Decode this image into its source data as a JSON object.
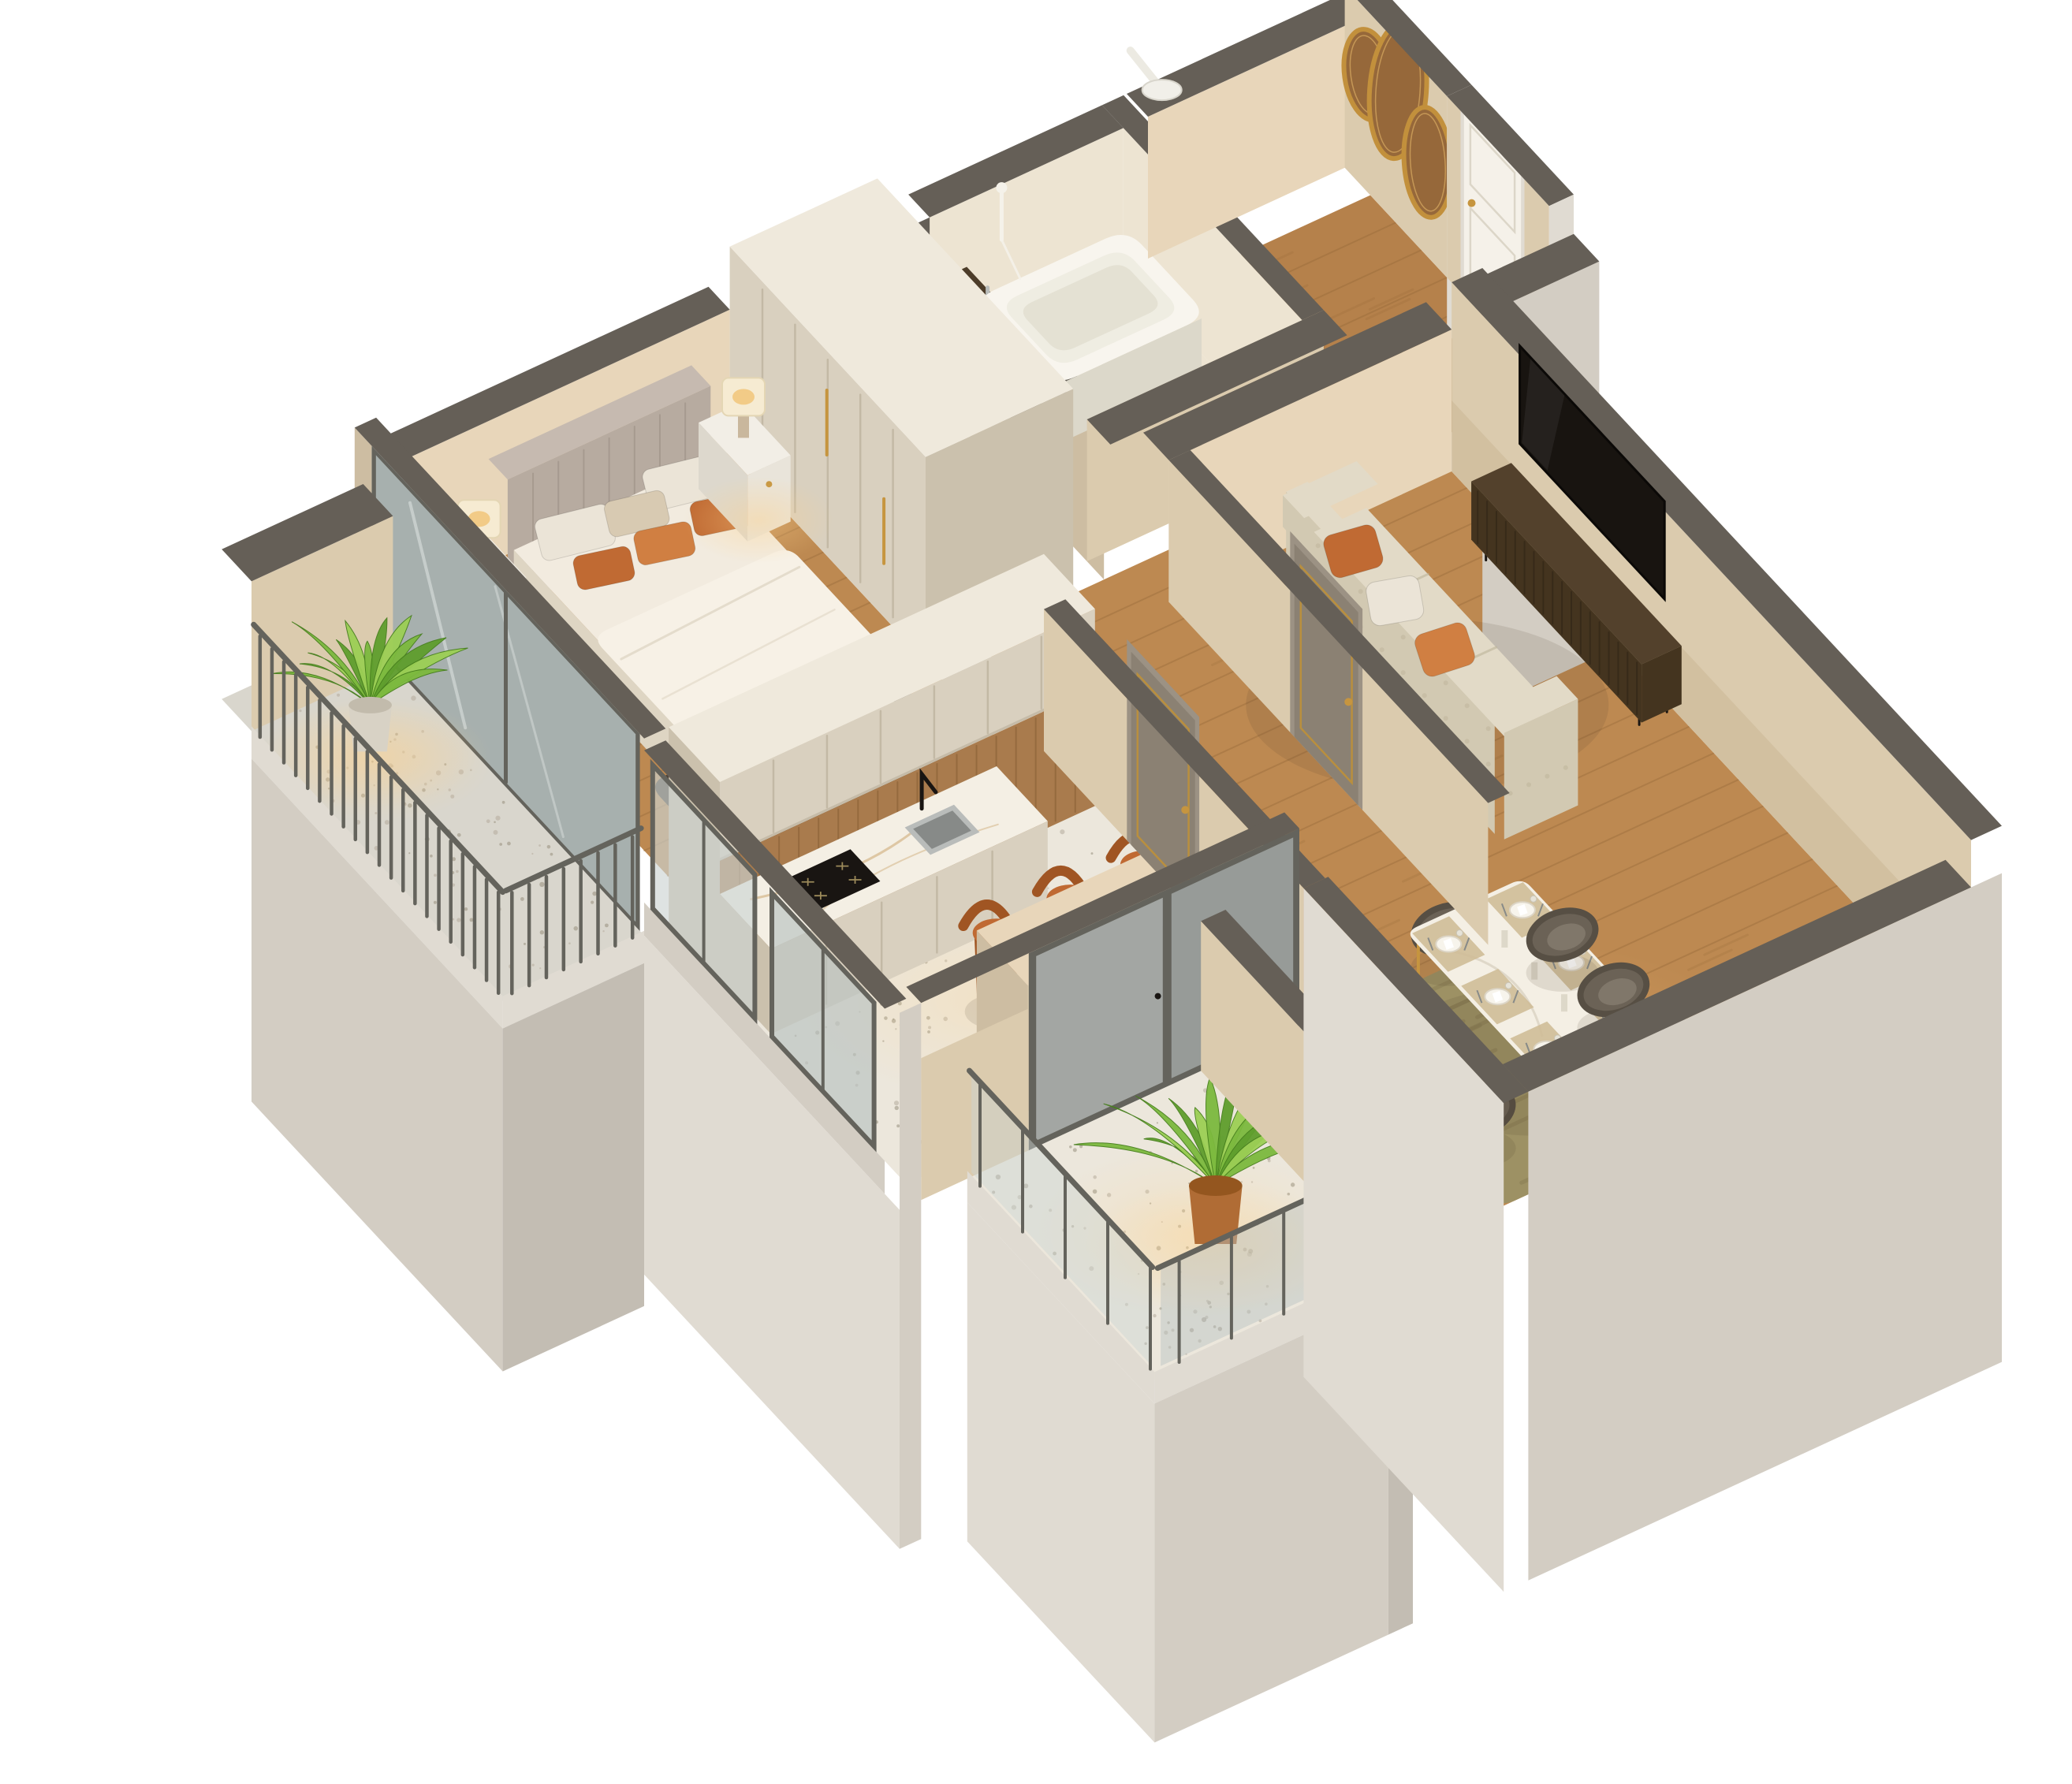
{
  "image": {
    "kind": "isometric-cutaway-apartment-render",
    "background": "#ffffff",
    "no_visible_text": true
  },
  "palette": {
    "wallTop": "#655f57",
    "wallTopL": "#736c63",
    "beigeLit": "#e8d6ba",
    "beige": "#dbcbae",
    "beigeShade": "#cdbda2",
    "tileWall": "#ede4d2",
    "cream": "#d9d0bf",
    "cream2": "#cbc1ad",
    "creamTop": "#efe9dc",
    "creamPanel": "#c1b7a3",
    "ext": "#d3cdc3",
    "extLight": "#e0dbd2",
    "extShade": "#c3bdb3",
    "woodA": "#bd8951",
    "woodSeam": "#8f6335",
    "woodEntry": "#b5814b",
    "terrazzo": "#ece7dc",
    "terrGray": "#d9d6cd",
    "speckA": "#b4ac9c",
    "speckB": "#978f7e",
    "marble": "#f4efe4",
    "marbleVein": "#c89f63",
    "woodPanel": "#a97b4d",
    "woodPanelSeam": "#855d33",
    "gold": "#c6953f",
    "doorBrown": "#8b8173",
    "doorBrownD": "#746a5c",
    "doorFrame": "#9c9284",
    "doorTrimGold": "#b98f3e",
    "whiteDoor": "#f5f1e9",
    "steel": "#b9bcba",
    "steelD": "#878a88",
    "black": "#191512",
    "tub": "#f8f5ee",
    "tubIn": "#efede2",
    "tubShade": "#dcd8ca",
    "vanity": "#4c3c29",
    "vanityD": "#3c2e1d",
    "bedHead": "#b7aba0",
    "bedHeadTop": "#c6bab0",
    "bedHeadD": "#a3978c",
    "linen": "#f2ebdf",
    "linenShade": "#ded5c3",
    "duvet": "#f7f1e6",
    "pillowW": "#ebe4d7",
    "pillowC": "#d8cab2",
    "orange": "#c06a33",
    "orangeD": "#a05523",
    "orangeL": "#d07f42",
    "rugDark": "#4f4337",
    "rugDarkL": "#635444",
    "rugOlive": "#9d9164",
    "rugOliveD": "#857a52",
    "sofa": "#e2dac7",
    "sofaShade": "#d2c9b2",
    "sofaD": "#bdb49a",
    "console": "#53412c",
    "consoleD": "#44341f",
    "slat": "#342818",
    "tv": "#181410",
    "chair": "#6b6256",
    "chairD": "#574f44",
    "chairL": "#80776a",
    "glass": "#cdd4d2",
    "glassDeep": "#b9c2c0",
    "frame": "#7b7a73",
    "frameD": "#64635c",
    "mirror": "#a7b0ae",
    "leafA": "#7cb93e",
    "leafB": "#5f9e2d",
    "leafC": "#9ccf55",
    "leafD": "#477f1e",
    "potMarble": "#d8d2c5",
    "potMarbleD": "#c2bbac",
    "potTerra": "#b06c35",
    "potTerraD": "#94561f",
    "lamp": "#f6ebd2",
    "lampGlow": "#f2c87e",
    "lampBase": "#c9b79d",
    "goldMirror": "#c2903c",
    "mirrorWood": "#96683a",
    "mirrorWoodD": "#7d5125",
    "shadow": "rgba(70,58,45,0.12)"
  },
  "scene": {
    "projection": "isometric dollhouse cutaway, white background",
    "rooms": [
      {
        "id": "bedroom",
        "floor": "wood",
        "items": [
          "double-bed",
          "upholstered-headboard",
          "white-and-orange-pillows",
          "two-white-nightstands",
          "two-table-lamps",
          "dark-area-rug"
        ]
      },
      {
        "id": "wardrobe",
        "floor": "wood",
        "items": [
          "tall-cream-paneled-wardrobe",
          "gold-handles"
        ]
      },
      {
        "id": "kitchen",
        "floor": "terrazzo",
        "items": [
          "tall-cabinet-partition",
          "upper-cabinets",
          "wood-plank-backsplash",
          "marble-countertop",
          "induction-cooktop",
          "undermount-sink",
          "black-faucet",
          "breakfast-bar",
          "three-orange-bar-stools",
          "corner-windows"
        ]
      },
      {
        "id": "bathroom",
        "floor": "tile",
        "items": [
          "bathtub",
          "handheld-shower",
          "dark-vanity-counter",
          "terrazzo-walls",
          "roof-vent"
        ]
      },
      {
        "id": "hallway",
        "floor": "wood",
        "items": [
          "brown-door-gold-trim-bedroom",
          "brown-door-gold-trim-living",
          "brown-door-gold-trim-bathroom"
        ]
      },
      {
        "id": "entry-hall",
        "floor": "wood",
        "items": [
          "white-front-door",
          "three-gold-organic-mirrors"
        ]
      },
      {
        "id": "dining-area",
        "floor": "wood",
        "items": [
          "marble-dining-table",
          "eight-dark-barrel-chairs",
          "six-place-settings",
          "olive-green-rug"
        ]
      },
      {
        "id": "living-room",
        "floor": "wood",
        "items": [
          "beige-tufted-sofa",
          "orange-throw-pillows",
          "walnut-slatted-tv-console",
          "wall-mounted-tv"
        ]
      },
      {
        "id": "balcony-left",
        "floor": "gray-terrazzo",
        "items": [
          "metal-slat-railing",
          "potted-plant-marble-pot",
          "sliding-mirror-glass-door"
        ]
      },
      {
        "id": "balcony-bottom",
        "floor": "terrazzo",
        "items": [
          "glass-railing",
          "potted-plant-terracotta-pot",
          "sliding-glass-door"
        ]
      }
    ]
  }
}
